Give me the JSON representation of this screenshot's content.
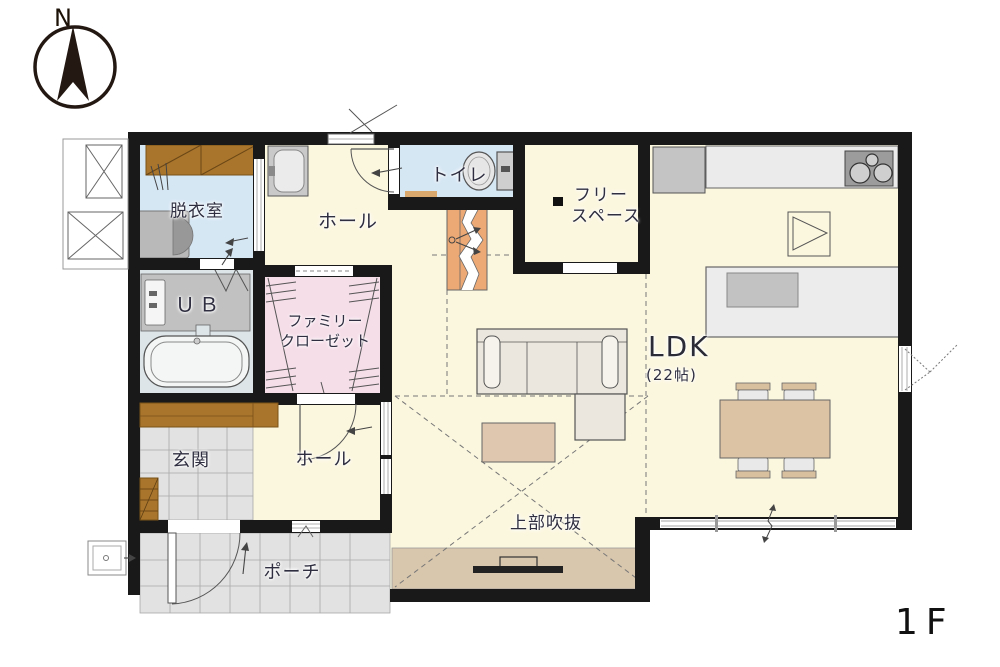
{
  "compass": {
    "north_label": "N"
  },
  "floor": {
    "label": "1F"
  },
  "rooms": {
    "dressing": {
      "label": "脱衣室"
    },
    "bath": {
      "label": "ＵＢ"
    },
    "closet": {
      "line1": "ファミリー",
      "line2": "クローゼット"
    },
    "hall_upper": {
      "label": "ホール"
    },
    "toilet": {
      "label": "トイレ"
    },
    "free_space": {
      "line1": "フリー",
      "line2": "スペース"
    },
    "ldk": {
      "label": "LDK",
      "size": "(22帖)"
    },
    "void": {
      "label": "上部吹抜"
    },
    "entrance": {
      "label": "玄関"
    },
    "hall_lower": {
      "label": "ホール"
    },
    "porch": {
      "label": "ポーチ"
    }
  },
  "colors": {
    "wall": "#191919",
    "floor_cream": "#fbf7df",
    "floor_blue": "#d6e7f4",
    "floor_pink": "#f6dee9",
    "tile_gray": "#e2e2e2",
    "wood_brown": "#a9752d",
    "stair_orange": "#eda975",
    "table_tan": "#dcc3a3",
    "tv_board_tan": "#d8c6ad",
    "counter_gray": "#ebebeb",
    "appliance_gray": "#c4c4c4",
    "bath_gray": "#c1c1c1"
  }
}
